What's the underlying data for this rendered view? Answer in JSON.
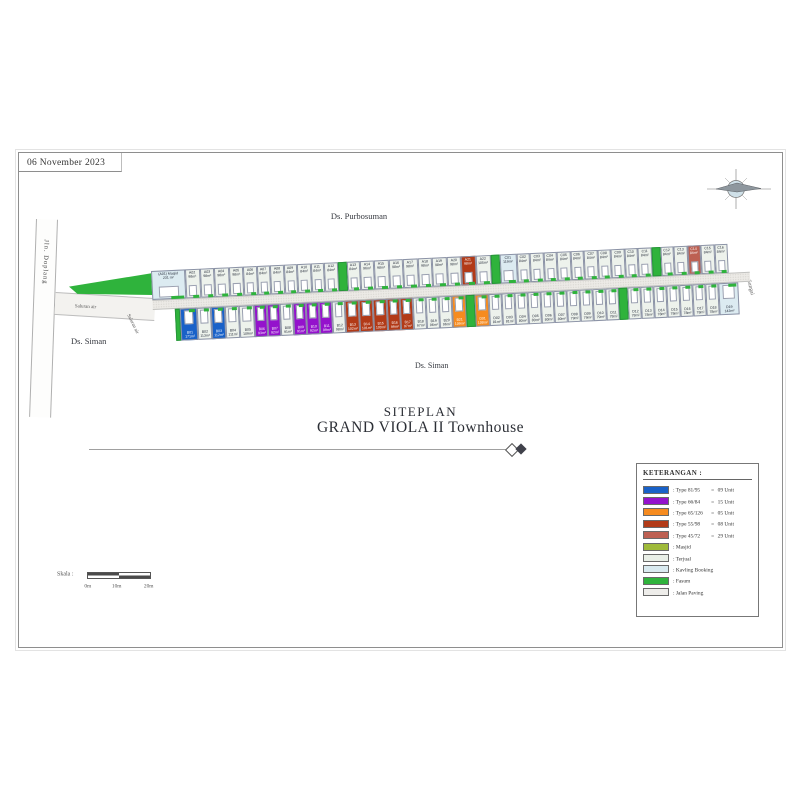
{
  "meta": {
    "date": "06 November 2023"
  },
  "labels": {
    "village_top": "Ds. Purbosuman",
    "village_left": "Ds. Siman",
    "village_bottom": "Ds. Siman",
    "road_left": "Jln. Doplang",
    "river_right": "Sungai",
    "waterway_1": "Saluran air",
    "waterway_2": "Saluran air"
  },
  "title": {
    "line1": "SITEPLAN",
    "line2": "GRAND VIOLA II Townhouse"
  },
  "scale": {
    "label": "Skala :",
    "ticks": [
      "0m",
      "10m",
      "20m"
    ]
  },
  "legend": {
    "title": "KETERANGAN :",
    "items": [
      {
        "key": "t8195",
        "color": "#1961c8",
        "label": ": Type 81/95",
        "eq": "=",
        "count": "09 Unit"
      },
      {
        "key": "t6684",
        "color": "#9412cc",
        "label": ": Type 66/84",
        "eq": "=",
        "count": "15 Unit"
      },
      {
        "key": "t65126",
        "color": "#f68b1f",
        "label": ": Type 65/126",
        "eq": "=",
        "count": "05 Unit"
      },
      {
        "key": "t5598",
        "color": "#b23a17",
        "label": ": Type 55/98",
        "eq": "=",
        "count": "08 Unit"
      },
      {
        "key": "t4572",
        "color": "#bd6052",
        "label": ": Type 45/72",
        "eq": "=",
        "count": "29 Unit"
      },
      {
        "key": "masjid",
        "color": "#9fba3a",
        "label": ": Masjid"
      },
      {
        "key": "terjual",
        "color": "#e9efe7",
        "label": ": Terjual"
      },
      {
        "key": "booking",
        "color": "#d9eaf0",
        "label": ": Kavling Booking"
      },
      {
        "key": "fasum",
        "color": "#2fb33c",
        "label": ": Fasum"
      },
      {
        "key": "paving",
        "color": "#eeedea",
        "label": ": Jalan Paving"
      }
    ]
  },
  "colors": {
    "t8195": "#1961c8",
    "t6684": "#9412cc",
    "t65126": "#f68b1f",
    "t5598": "#b23a17",
    "t4572": "#bd6052",
    "masjid": "#9fba3a",
    "terjual": "#edf2ec",
    "booking": "#dcebf1",
    "fasum": "#2fb33c",
    "paving": "#eeedea"
  },
  "dark_types": [
    "t8195",
    "t6684",
    "t65126",
    "t5598",
    "t4572"
  ],
  "siteplan": {
    "top_row": [
      {
        "id": "(A01) Masjid",
        "area": "231 m²",
        "type": "booking",
        "w": 34
      },
      {
        "id": "A02",
        "area": "98m²",
        "type": "terjual",
        "w": 14.5
      },
      {
        "id": "A03",
        "area": "98m²",
        "type": "terjual",
        "w": 14.5
      },
      {
        "id": "A04",
        "area": "98m²",
        "type": "terjual",
        "w": 14.5
      },
      {
        "id": "A05",
        "area": "98m²",
        "type": "terjual",
        "w": 14.5
      },
      {
        "id": "A06",
        "area": "84m²",
        "type": "terjual",
        "w": 13.5
      },
      {
        "id": "A07",
        "area": "84m²",
        "type": "terjual",
        "w": 13.5
      },
      {
        "id": "A08",
        "area": "84m²",
        "type": "terjual",
        "w": 13.5
      },
      {
        "id": "A09",
        "area": "84m²",
        "type": "terjual",
        "w": 13.5
      },
      {
        "id": "A10",
        "area": "84m²",
        "type": "terjual",
        "w": 13.5
      },
      {
        "id": "A11",
        "area": "84m²",
        "type": "terjual",
        "w": 13.5
      },
      {
        "id": "A12",
        "area": "84m²",
        "type": "terjual",
        "w": 13.5
      },
      {
        "type": "fasum",
        "w": 9
      },
      {
        "id": "A13",
        "area": "84m²",
        "type": "terjual",
        "w": 13.5
      },
      {
        "id": "A14",
        "area": "96m²",
        "type": "terjual",
        "w": 14
      },
      {
        "id": "A15",
        "area": "98m²",
        "type": "terjual",
        "w": 14.5
      },
      {
        "id": "A16",
        "area": "98m²",
        "type": "terjual",
        "w": 14.5
      },
      {
        "id": "A17",
        "area": "98m²",
        "type": "terjual",
        "w": 14.5
      },
      {
        "id": "A18",
        "area": "98m²",
        "type": "terjual",
        "w": 14.5
      },
      {
        "id": "A19",
        "area": "98m²",
        "type": "terjual",
        "w": 14.5
      },
      {
        "id": "A20",
        "area": "98m²",
        "type": "terjual",
        "w": 14.5
      },
      {
        "id": "A21",
        "area": "98m²",
        "type": "t5598",
        "w": 14.5
      },
      {
        "id": "A22",
        "area": "105m²",
        "type": "terjual",
        "w": 15
      },
      {
        "type": "fasum",
        "w": 9
      },
      {
        "id": "C01",
        "area": "119m²",
        "type": "booking",
        "w": 17
      },
      {
        "id": "C02",
        "area": "84m²",
        "type": "terjual",
        "w": 13.5
      },
      {
        "id": "C03",
        "area": "84m²",
        "type": "terjual",
        "w": 13.5
      },
      {
        "id": "C04",
        "area": "84m²",
        "type": "terjual",
        "w": 13.5
      },
      {
        "id": "C05",
        "area": "84m²",
        "type": "terjual",
        "w": 13.5
      },
      {
        "id": "C06",
        "area": "84m²",
        "type": "terjual",
        "w": 13.5
      },
      {
        "id": "C07",
        "area": "84m²",
        "type": "terjual",
        "w": 13.5
      },
      {
        "id": "C08",
        "area": "84m²",
        "type": "terjual",
        "w": 13.5
      },
      {
        "id": "C09",
        "area": "84m²",
        "type": "terjual",
        "w": 13.5
      },
      {
        "id": "C10",
        "area": "84m²",
        "type": "terjual",
        "w": 13.5
      },
      {
        "id": "C11",
        "area": "84m²",
        "type": "terjual",
        "w": 13.5
      },
      {
        "type": "fasum",
        "w": 9
      },
      {
        "id": "C12",
        "area": "84m²",
        "type": "terjual",
        "w": 13.5
      },
      {
        "id": "C13",
        "area": "84m²",
        "type": "terjual",
        "w": 13.5
      },
      {
        "id": "C14",
        "area": "84m²",
        "type": "t4572",
        "w": 13.5
      },
      {
        "id": "C15",
        "area": "84m²",
        "type": "terjual",
        "w": 13.5
      },
      {
        "id": "C16",
        "area": "84m²",
        "type": "terjual",
        "w": 13.5
      }
    ],
    "bottom_row": [
      {
        "type": "fasum",
        "w": 5
      },
      {
        "id": "B01",
        "area": "171m²",
        "type": "t8195",
        "w": 17
      },
      {
        "id": "B02",
        "area": "113m²",
        "type": "terjual",
        "w": 14
      },
      {
        "id": "B03",
        "area": "112m²",
        "type": "t8195",
        "w": 14
      },
      {
        "id": "B04",
        "area": "111m²",
        "type": "terjual",
        "w": 14
      },
      {
        "id": "B05",
        "area": "109m²",
        "type": "terjual",
        "w": 15
      },
      {
        "id": "B06",
        "area": "93m²",
        "type": "t6684",
        "w": 13
      },
      {
        "id": "B07",
        "area": "92m²",
        "type": "t6684",
        "w": 13
      },
      {
        "id": "B08",
        "area": "91m²",
        "type": "terjual",
        "w": 13
      },
      {
        "id": "B09",
        "area": "91m²",
        "type": "t6684",
        "w": 13
      },
      {
        "id": "B10",
        "area": "92m²",
        "type": "t6684",
        "w": 13
      },
      {
        "id": "B11",
        "area": "99m²",
        "type": "t6684",
        "w": 13
      },
      {
        "id": "B12",
        "area": "98m²",
        "type": "terjual",
        "w": 13
      },
      {
        "id": "B13",
        "area": "102m²",
        "type": "t5598",
        "w": 14
      },
      {
        "id": "B14",
        "area": "101m²",
        "type": "t5598",
        "w": 14
      },
      {
        "id": "B15",
        "area": "100m²",
        "type": "t5598",
        "w": 14
      },
      {
        "id": "B16",
        "area": "99m²",
        "type": "t5598",
        "w": 13
      },
      {
        "id": "B17",
        "area": "97m²",
        "type": "t5598",
        "w": 13
      },
      {
        "id": "B18",
        "area": "97m²",
        "type": "terjual",
        "w": 13
      },
      {
        "id": "B19",
        "area": "96m²",
        "type": "terjual",
        "w": 13
      },
      {
        "id": "B20",
        "area": "96m²",
        "type": "terjual",
        "w": 13
      },
      {
        "id": "B21",
        "area": "109m²",
        "type": "t65126",
        "w": 14
      },
      {
        "type": "fasum",
        "w": 9
      },
      {
        "id": "D01",
        "area": "108m²",
        "type": "t65126",
        "w": 14
      },
      {
        "id": "D02",
        "area": "81m²",
        "type": "terjual",
        "w": 13
      },
      {
        "id": "D03",
        "area": "81m²",
        "type": "terjual",
        "w": 13
      },
      {
        "id": "D04",
        "area": "80m²",
        "type": "terjual",
        "w": 13
      },
      {
        "id": "D05",
        "area": "80m²",
        "type": "terjual",
        "w": 13
      },
      {
        "id": "D06",
        "area": "80m²",
        "type": "terjual",
        "w": 13
      },
      {
        "id": "D07",
        "area": "80m²",
        "type": "terjual",
        "w": 13
      },
      {
        "id": "D08",
        "area": "79m²",
        "type": "terjual",
        "w": 13
      },
      {
        "id": "D09",
        "area": "79m²",
        "type": "terjual",
        "w": 13
      },
      {
        "id": "D10",
        "area": "79m²",
        "type": "terjual",
        "w": 13
      },
      {
        "id": "D11",
        "area": "78m²",
        "type": "terjual",
        "w": 13
      },
      {
        "type": "fasum",
        "w": 9
      },
      {
        "id": "D12",
        "area": "78m²",
        "type": "terjual",
        "w": 13
      },
      {
        "id": "D13",
        "area": "78m²",
        "type": "terjual",
        "w": 13
      },
      {
        "id": "D14",
        "area": "78m²",
        "type": "terjual",
        "w": 13
      },
      {
        "id": "D15",
        "area": "78m²",
        "type": "terjual",
        "w": 13
      },
      {
        "id": "D16",
        "area": "78m²",
        "type": "terjual",
        "w": 13
      },
      {
        "id": "D17",
        "area": "78m²",
        "type": "terjual",
        "w": 13
      },
      {
        "id": "D18",
        "area": "78m²",
        "type": "terjual",
        "w": 13
      },
      {
        "id": "D19",
        "area": "142m²",
        "type": "booking",
        "w": 20
      }
    ]
  }
}
